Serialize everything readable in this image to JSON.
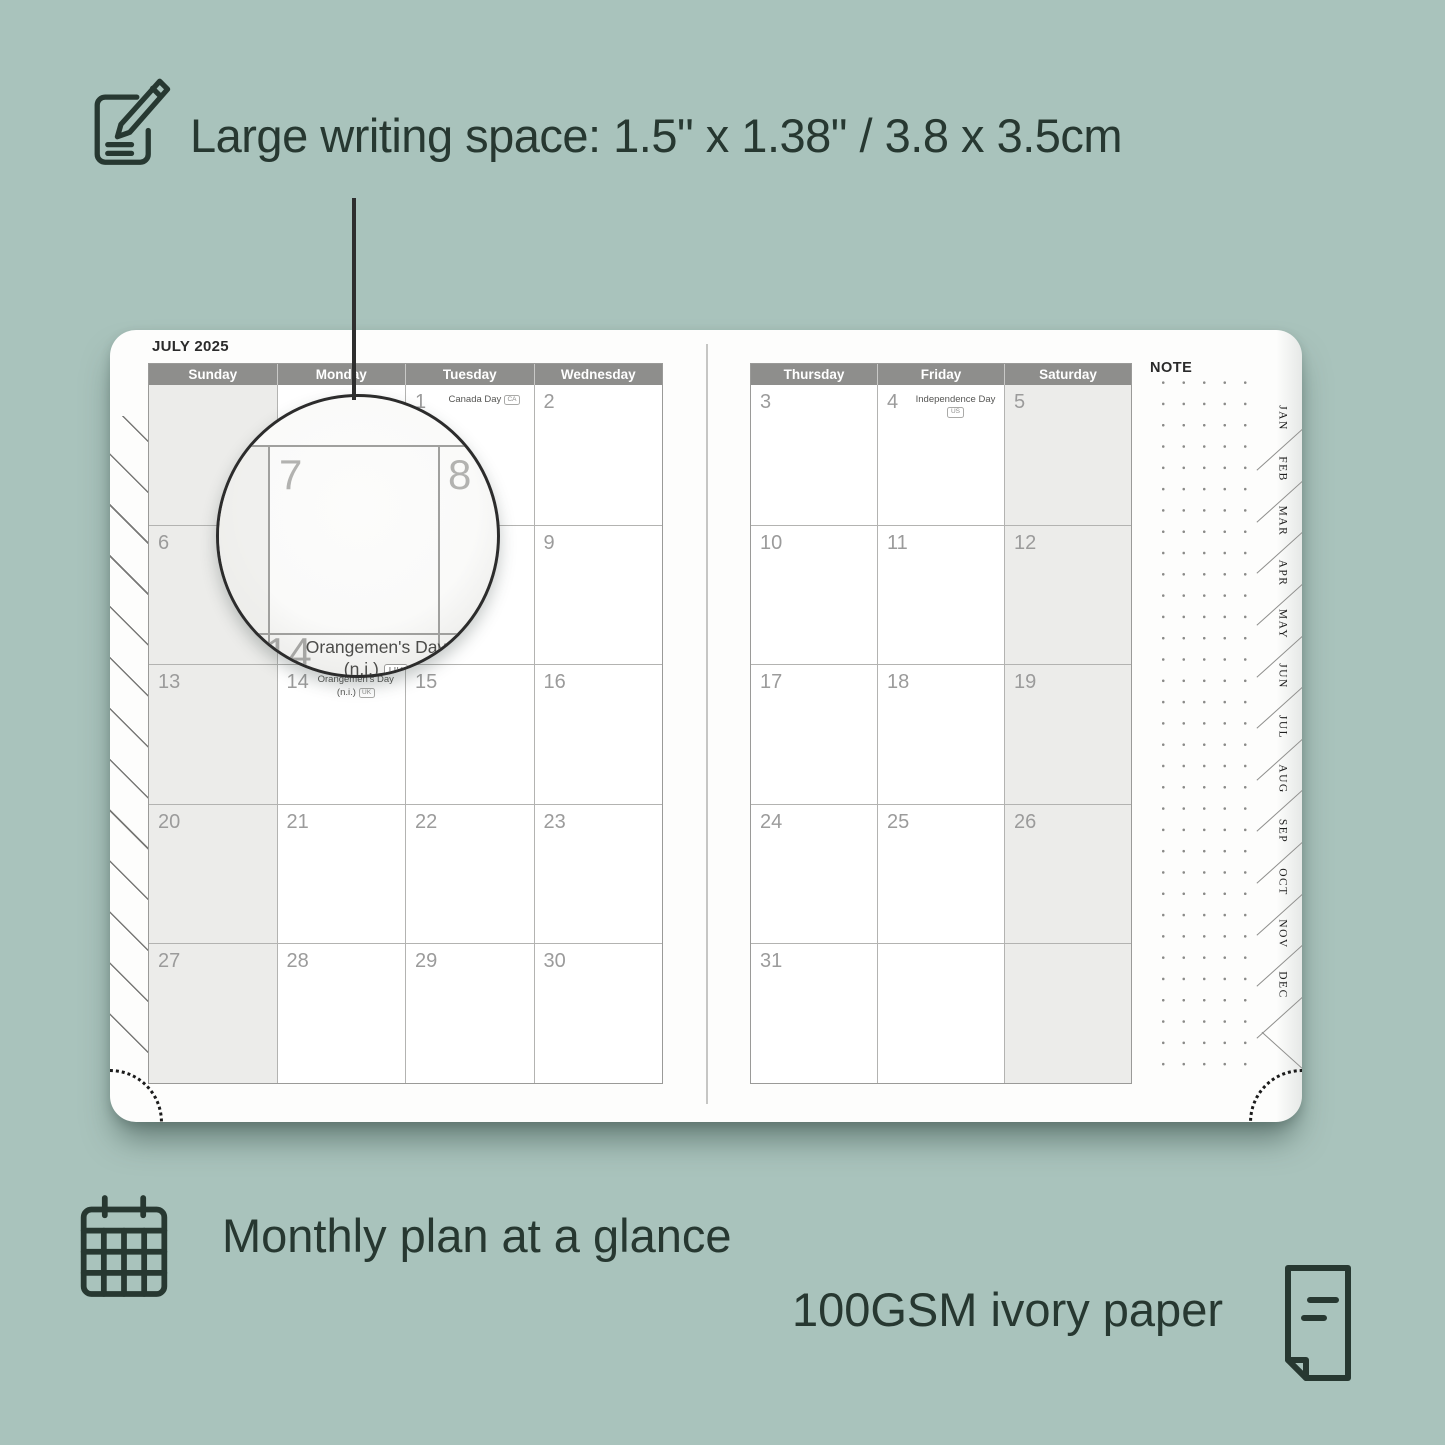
{
  "annotations": {
    "top_feature": "Large writing space: 1.5\" x 1.38\" / 3.8 x 3.5cm",
    "feature_monthly": "Monthly plan at a glance",
    "feature_paper": "100GSM ivory paper"
  },
  "planner": {
    "month_title": "JULY 2025",
    "note_label": "NOTE",
    "left_page_headers": [
      "Sunday",
      "Monday",
      "Tuesday",
      "Wednesday"
    ],
    "right_page_headers": [
      "Thursday",
      "Friday",
      "Saturday"
    ],
    "month_tabs": [
      "JAN",
      "FEB",
      "MAR",
      "APR",
      "MAY",
      "JUN",
      "JUL",
      "AUG",
      "SEP",
      "OCT",
      "NOV",
      "DEC"
    ],
    "left_shaded_column": 0,
    "right_shaded_column": 2,
    "left_rows": [
      [
        {
          "date": ""
        },
        {
          "date": ""
        },
        {
          "date": "1",
          "holiday": "Canada Day",
          "badge": "CA"
        },
        {
          "date": "2"
        }
      ],
      [
        {
          "date": "6"
        },
        {
          "date": "7"
        },
        {
          "date": "8"
        },
        {
          "date": "9"
        }
      ],
      [
        {
          "date": "13"
        },
        {
          "date": "14",
          "holiday": "Orangemen's Day",
          "holiday2": "(n.i.)",
          "badge": "UK"
        },
        {
          "date": "15"
        },
        {
          "date": "16"
        }
      ],
      [
        {
          "date": "20"
        },
        {
          "date": "21"
        },
        {
          "date": "22"
        },
        {
          "date": "23"
        }
      ],
      [
        {
          "date": "27"
        },
        {
          "date": "28"
        },
        {
          "date": "29"
        },
        {
          "date": "30"
        }
      ]
    ],
    "right_rows": [
      [
        {
          "date": "3"
        },
        {
          "date": "4",
          "holiday": "Independence Day",
          "badge": "US"
        },
        {
          "date": "5"
        }
      ],
      [
        {
          "date": "10"
        },
        {
          "date": "11"
        },
        {
          "date": "12"
        }
      ],
      [
        {
          "date": "17"
        },
        {
          "date": "18"
        },
        {
          "date": "19"
        }
      ],
      [
        {
          "date": "24"
        },
        {
          "date": "25"
        },
        {
          "date": "26"
        }
      ],
      [
        {
          "date": "31"
        },
        {
          "date": ""
        },
        {
          "date": ""
        }
      ]
    ],
    "magnifier": {
      "date_top_left": "7",
      "date_top_right": "8",
      "date_bottom": "14",
      "holiday_line1": "Orangemen's Day",
      "holiday_line2": "(n.i.)",
      "badge": "UK"
    }
  },
  "colors": {
    "background": "#a9c3bc",
    "ink": "#273831",
    "header_bar": "#8e8e8c",
    "weekend_fill": "#ececea",
    "date_number": "#9b9b9b"
  }
}
